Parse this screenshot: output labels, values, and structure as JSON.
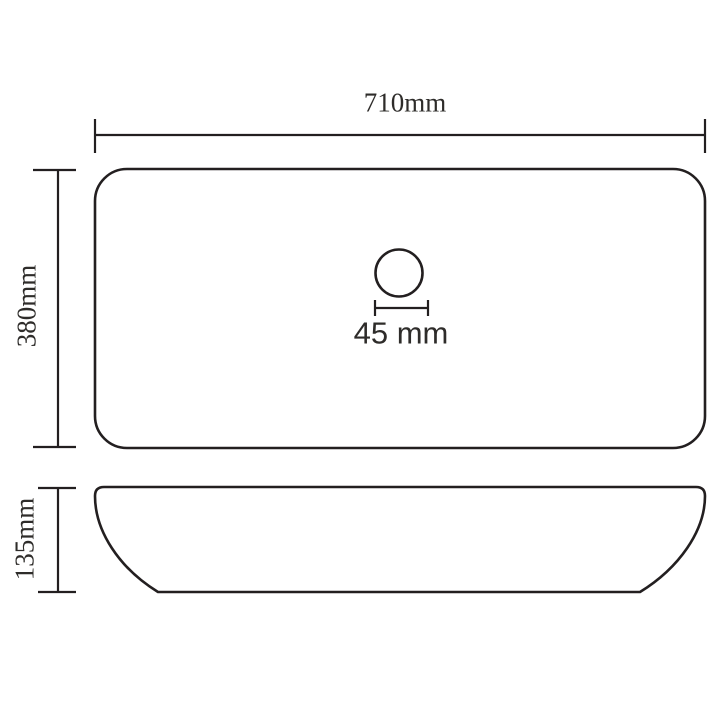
{
  "canvas": {
    "background_color": "#ffffff"
  },
  "style": {
    "line_color": "#231f20",
    "text_color": "#2e2c2a"
  },
  "diagram": {
    "type": "product-dimension-drawing",
    "views": {
      "top_view": {
        "shape": "rounded-rectangle",
        "feature": "drain-hole-circle"
      },
      "side_view": {
        "shape": "basin-profile"
      }
    },
    "dimensions": {
      "width": {
        "label": "710mm",
        "value": 710,
        "unit": "mm"
      },
      "depth": {
        "label": "380mm",
        "value": 380,
        "unit": "mm"
      },
      "height": {
        "label": "135mm",
        "value": 135,
        "unit": "mm"
      },
      "drain_diameter": {
        "label": "45 mm",
        "value": 45,
        "unit": "mm"
      }
    }
  }
}
